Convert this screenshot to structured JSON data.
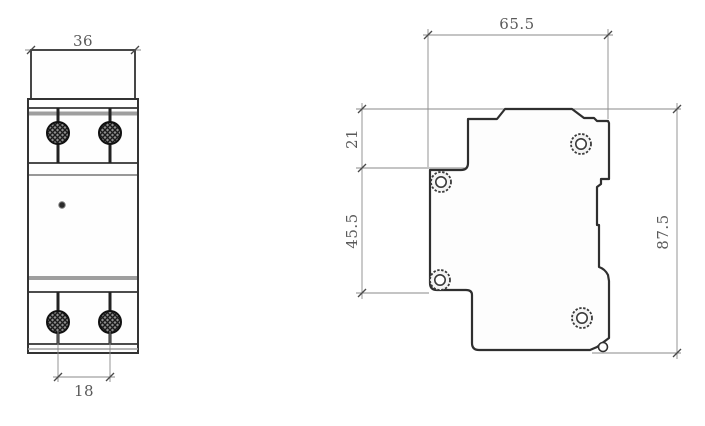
{
  "drawing": {
    "type": "technical-dimension-drawing",
    "background": "#ffffff",
    "line_color": "#333333",
    "dim_color": "#5a5a5a",
    "accent_gray": "#9e9e9e",
    "front_view": {
      "name": "front view (DIN-rail module, 2 terminals top and bottom)",
      "dims": {
        "overall_width": "36",
        "terminal_pitch": "18"
      }
    },
    "side_view": {
      "name": "side profile view with DIN-rail slot",
      "dims": {
        "depth": "65.5",
        "top_offset": "21",
        "mid_height": "45.5",
        "overall_height": "87.5"
      }
    }
  }
}
